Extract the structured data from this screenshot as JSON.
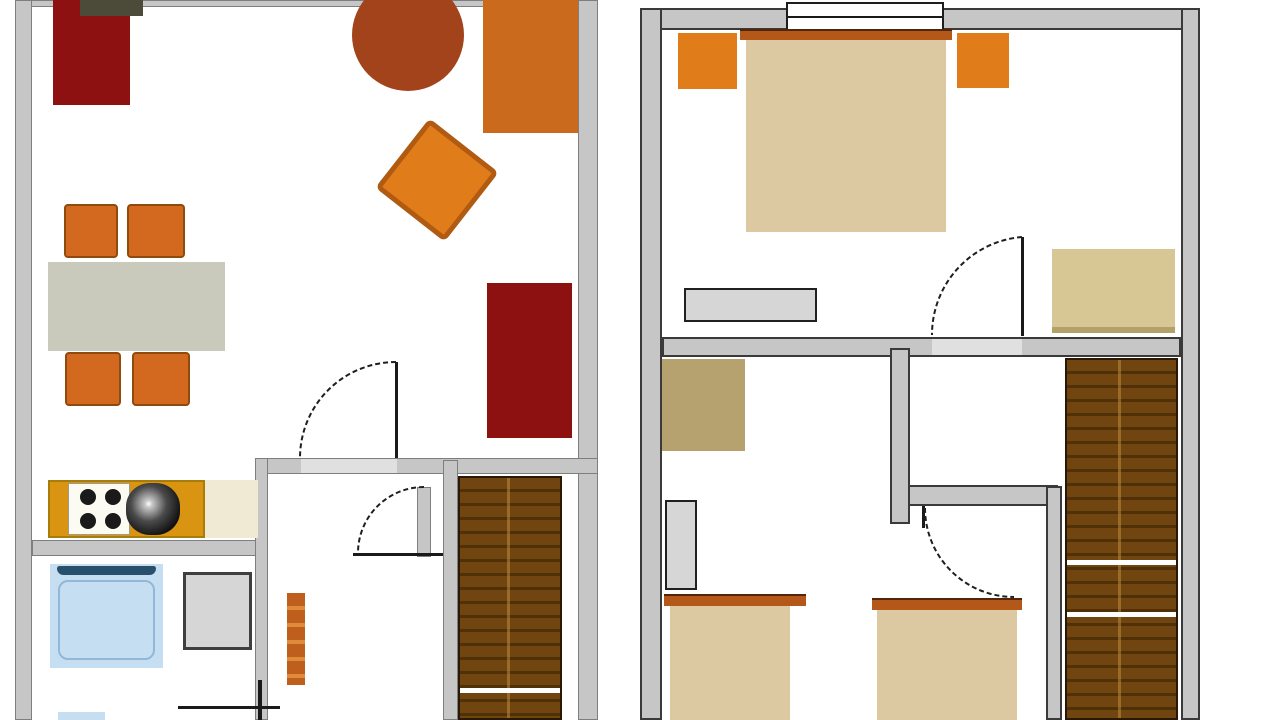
{
  "title": "Two-storey apartment floor plan",
  "floors": [
    {
      "id": "ground-floor",
      "position": "left",
      "rooms": [
        "living-room",
        "dining-area",
        "kitchen",
        "bathroom",
        "hallway",
        "staircase"
      ]
    },
    {
      "id": "upper-floor",
      "position": "right",
      "rooms": [
        "bedroom-main",
        "bedroom-second",
        "landing",
        "staircase"
      ]
    }
  ],
  "palette": {
    "wall": "#c6c6c6",
    "threshold": "#e0e0e0",
    "darkRed": "#8e1111",
    "tvOlive": "#4c4a38",
    "sienna": "#a2431b",
    "orange": "#d2691e",
    "brightOrange": "#e07c1a",
    "sofaOrange": "#c96a1c",
    "tableGray": "#c9c9bc",
    "counterGold": "#d99411",
    "counterCream": "#f0ead4",
    "stoveWhite": "#fbfbf2",
    "black": "#1a1a1a",
    "tubBlue": "#c6def2",
    "tubEdge": "#29506b",
    "applianceGray": "#d6d6d6",
    "radiatorOrange": "#bf5f1d",
    "radiatorLight": "#e08a3c",
    "stairWood": "#714510",
    "stairStep": "#4f3007",
    "bedTan": "#dcc8a1",
    "headboardSienna": "#b4581a",
    "deskKhaki": "#b5a26e",
    "dresserTan": "#d7c794",
    "dresserTanEdge": "#b2a169",
    "white": "#ffffff",
    "doorStroke": "#1f1f1f"
  },
  "shapes": [
    {
      "n": "gf-top-wall",
      "k": "wall",
      "c": "wall",
      "x": 15,
      "y": 0,
      "w": 583,
      "h": 7
    },
    {
      "n": "gf-left-wall",
      "k": "wall",
      "c": "wall",
      "x": 15,
      "y": 0,
      "w": 17,
      "h": 720
    },
    {
      "n": "gf-right-wall",
      "k": "wall",
      "c": "wall",
      "x": 578,
      "y": 0,
      "w": 20,
      "h": 720
    },
    {
      "n": "gf-hall-wall",
      "k": "wall",
      "c": "wall",
      "x": 255,
      "y": 458,
      "w": 343,
      "h": 16
    },
    {
      "n": "gf-living-doorway",
      "k": "threshold",
      "c": "threshold",
      "x": 301,
      "y": 459,
      "w": 96,
      "h": 14
    },
    {
      "n": "gf-kitchen-bath-wall",
      "k": "wall",
      "c": "wall",
      "x": 32,
      "y": 540,
      "w": 236,
      "h": 16
    },
    {
      "n": "gf-bath-hall-wall",
      "k": "wall",
      "c": "wall",
      "x": 255,
      "y": 458,
      "w": 13,
      "h": 262
    },
    {
      "n": "gf-stair-wall",
      "k": "wall",
      "c": "wall",
      "x": 443,
      "y": 460,
      "w": 15,
      "h": 260
    },
    {
      "n": "gf-stair-door-jamb",
      "k": "wall",
      "c": "wall",
      "x": 417,
      "y": 487,
      "w": 14,
      "h": 70
    },
    {
      "n": "tv-stand",
      "k": "rect",
      "c": "darkRed",
      "x": 53,
      "y": 0,
      "w": 77,
      "h": 105
    },
    {
      "n": "tv-set",
      "k": "rect",
      "c": "tvOlive",
      "x": 80,
      "y": 0,
      "w": 63,
      "h": 16
    },
    {
      "n": "coffee-table",
      "k": "circle",
      "c": "sienna",
      "x": 352,
      "y": -21,
      "w": 112,
      "h": 112
    },
    {
      "n": "sofa",
      "k": "sofa",
      "c": "sofaOrange",
      "x": 483,
      "y": 0,
      "w": 95,
      "h": 133
    },
    {
      "n": "armchair-rotated",
      "k": "armchair",
      "c": "brightOrange",
      "x": 393,
      "y": 136,
      "w": 88,
      "h": 88,
      "r": 38
    },
    {
      "n": "dining-chair-1",
      "k": "chair",
      "c": "orange",
      "x": 64,
      "y": 204,
      "w": 54,
      "h": 54
    },
    {
      "n": "dining-chair-2",
      "k": "chair",
      "c": "orange",
      "x": 127,
      "y": 204,
      "w": 58,
      "h": 54
    },
    {
      "n": "dining-table",
      "k": "rect",
      "c": "tableGray",
      "x": 48,
      "y": 262,
      "w": 177,
      "h": 89
    },
    {
      "n": "dining-chair-3",
      "k": "chair",
      "c": "orange",
      "x": 65,
      "y": 352,
      "w": 56,
      "h": 54
    },
    {
      "n": "dining-chair-4",
      "k": "chair",
      "c": "orange",
      "x": 132,
      "y": 352,
      "w": 58,
      "h": 54
    },
    {
      "n": "reading-chair",
      "k": "rect",
      "c": "darkRed",
      "x": 487,
      "y": 283,
      "w": 85,
      "h": 155
    },
    {
      "n": "kitchen-counter",
      "k": "counter",
      "c": "counterGold",
      "x": 48,
      "y": 480,
      "w": 157,
      "h": 58
    },
    {
      "n": "stove",
      "k": "stove",
      "c": "stoveWhite",
      "x": 68,
      "y": 483,
      "w": 62,
      "h": 52
    },
    {
      "n": "burner-1",
      "k": "burner",
      "c": "black",
      "x": 80,
      "y": 489,
      "w": 16,
      "h": 16
    },
    {
      "n": "burner-2",
      "k": "burner",
      "c": "black",
      "x": 105,
      "y": 489,
      "w": 16,
      "h": 16
    },
    {
      "n": "burner-3",
      "k": "burner",
      "c": "black",
      "x": 80,
      "y": 513,
      "w": 16,
      "h": 16
    },
    {
      "n": "burner-4",
      "k": "burner",
      "c": "black",
      "x": 105,
      "y": 513,
      "w": 16,
      "h": 16
    },
    {
      "n": "kitchen-sink",
      "k": "sink",
      "c": "black",
      "x": 126,
      "y": 483,
      "w": 54,
      "h": 52
    },
    {
      "n": "counter-worktop",
      "k": "rect",
      "c": "counterCream",
      "x": 205,
      "y": 480,
      "w": 53,
      "h": 58
    },
    {
      "n": "bathtub",
      "k": "tub",
      "c": "tubBlue",
      "x": 50,
      "y": 564,
      "w": 113,
      "h": 104
    },
    {
      "n": "bathtub-rim",
      "k": "tubbar",
      "c": "tubEdge",
      "x": 57,
      "y": 566,
      "w": 99,
      "h": 9
    },
    {
      "n": "bathtub-inner",
      "k": "tubinner",
      "x": 58,
      "y": 580,
      "w": 97,
      "h": 80
    },
    {
      "n": "washing-machine",
      "k": "appliance",
      "c": "applianceGray",
      "x": 183,
      "y": 572,
      "w": 69,
      "h": 78
    },
    {
      "n": "bathroom-sink",
      "k": "rect",
      "c": "tubBlue",
      "x": 58,
      "y": 712,
      "w": 47,
      "h": 8
    },
    {
      "n": "hall-radiator",
      "k": "radiator",
      "c": "radiatorOrange",
      "c2": "radiatorLight",
      "x": 287,
      "y": 593,
      "w": 18,
      "h": 92
    },
    {
      "n": "bath-door-frame-h",
      "k": "line",
      "c": "black",
      "x": 178,
      "y": 706,
      "w": 102,
      "h": 3
    },
    {
      "n": "bath-door-frame-v",
      "k": "line",
      "c": "black",
      "x": 258,
      "y": 680,
      "w": 4,
      "h": 40
    },
    {
      "n": "gf-staircase",
      "k": "stairs",
      "c": "stairWood",
      "c2": "stairStep",
      "x": 458,
      "y": 476,
      "w": 104,
      "h": 244
    },
    {
      "n": "gf-stair-landing-line",
      "k": "divider",
      "c": "white",
      "x": 460,
      "y": 688,
      "w": 100,
      "h": 5
    },
    {
      "n": "living-door-leaf",
      "k": "doorleaf",
      "c": "black",
      "x": 395,
      "y": 362,
      "w": 3,
      "h": 96
    },
    {
      "n": "stair-door-leaf",
      "k": "doorleaf",
      "c": "black",
      "x": 353,
      "y": 553,
      "w": 90,
      "h": 3
    },
    {
      "n": "uf-top-wall",
      "k": "wallb",
      "c": "wall",
      "x": 640,
      "y": 8,
      "w": 560,
      "h": 22
    },
    {
      "n": "uf-left-wall",
      "k": "wallb",
      "c": "wall",
      "x": 640,
      "y": 8,
      "w": 22,
      "h": 712
    },
    {
      "n": "uf-right-wall",
      "k": "wallb",
      "c": "wall",
      "x": 1181,
      "y": 8,
      "w": 19,
      "h": 712
    },
    {
      "n": "uf-bedroom-wall",
      "k": "wallb",
      "c": "wall",
      "x": 662,
      "y": 337,
      "w": 519,
      "h": 20
    },
    {
      "n": "uf-bedroom-doorway",
      "k": "threshold",
      "c": "threshold",
      "x": 932,
      "y": 339,
      "w": 90,
      "h": 16
    },
    {
      "n": "uf-inner-wall-vertical",
      "k": "wallb",
      "c": "wall",
      "x": 890,
      "y": 348,
      "w": 20,
      "h": 176
    },
    {
      "n": "uf-inner-wall-horizontal",
      "k": "wallb",
      "c": "wall",
      "x": 908,
      "y": 485,
      "w": 150,
      "h": 21
    },
    {
      "n": "uf-stair-wall",
      "k": "wallb",
      "c": "wall",
      "x": 1046,
      "y": 486,
      "w": 16,
      "h": 234
    },
    {
      "n": "bedroom-window",
      "k": "window",
      "x": 786,
      "y": 2,
      "w": 158,
      "h": 38
    },
    {
      "n": "bedroom-window-mullion",
      "k": "line",
      "c": "black",
      "x": 788,
      "y": 16,
      "w": 154,
      "h": 2
    },
    {
      "n": "double-bed-headboard",
      "k": "headboard",
      "c": "headboardSienna",
      "x": 740,
      "y": 29,
      "w": 212,
      "h": 11
    },
    {
      "n": "double-bed",
      "k": "bed",
      "c": "bedTan",
      "x": 746,
      "y": 40,
      "w": 200,
      "h": 192
    },
    {
      "n": "nightstand-left",
      "k": "rect",
      "c": "brightOrange",
      "x": 678,
      "y": 33,
      "w": 59,
      "h": 56
    },
    {
      "n": "nightstand-right",
      "k": "rect",
      "c": "brightOrange",
      "x": 957,
      "y": 33,
      "w": 52,
      "h": 55
    },
    {
      "n": "bedroom-dresser-low",
      "k": "dresser",
      "c": "applianceGray",
      "x": 684,
      "y": 288,
      "w": 133,
      "h": 34
    },
    {
      "n": "bedroom-chest-tan",
      "k": "rect",
      "c": "dresserTan",
      "x": 1052,
      "y": 249,
      "w": 123,
      "h": 84
    },
    {
      "n": "bedroom-chest-tan-edge",
      "k": "line",
      "c": "dresserTanEdge",
      "x": 1052,
      "y": 327,
      "w": 123,
      "h": 6
    },
    {
      "n": "bedroom-door-leaf",
      "k": "doorleaf",
      "c": "black",
      "x": 1021,
      "y": 237,
      "w": 3,
      "h": 99
    },
    {
      "n": "desk",
      "k": "rect",
      "c": "deskKhaki",
      "x": 662,
      "y": 359,
      "w": 83,
      "h": 92
    },
    {
      "n": "wardrobe",
      "k": "dresser",
      "c": "applianceGray",
      "x": 665,
      "y": 500,
      "w": 32,
      "h": 90
    },
    {
      "n": "single-bed-1-headboard",
      "k": "headboard",
      "c": "headboardSienna",
      "x": 664,
      "y": 594,
      "w": 142,
      "h": 12
    },
    {
      "n": "single-bed-1",
      "k": "bed",
      "c": "bedTan",
      "x": 670,
      "y": 606,
      "w": 120,
      "h": 114
    },
    {
      "n": "single-bed-2-headboard",
      "k": "headboard",
      "c": "headboardSienna",
      "x": 872,
      "y": 598,
      "w": 150,
      "h": 12
    },
    {
      "n": "single-bed-2",
      "k": "bed",
      "c": "bedTan",
      "x": 877,
      "y": 610,
      "w": 140,
      "h": 110
    },
    {
      "n": "uf-staircase",
      "k": "stairs",
      "c": "stairWood",
      "c2": "stairStep",
      "x": 1065,
      "y": 358,
      "w": 113,
      "h": 362
    },
    {
      "n": "uf-stair-landing-line-1",
      "k": "divider",
      "c": "white",
      "x": 1067,
      "y": 560,
      "w": 109,
      "h": 5
    },
    {
      "n": "uf-stair-landing-line-2",
      "k": "divider",
      "c": "white",
      "x": 1067,
      "y": 612,
      "w": 109,
      "h": 5
    },
    {
      "n": "second-bedroom-door-leaf",
      "k": "doorleaf",
      "c": "black",
      "x": 922,
      "y": 506,
      "w": 3,
      "h": 22
    }
  ],
  "door_arcs": [
    {
      "n": "living-door-arc",
      "d": "M 396 362 A 96 96 0 0 0 300 458"
    },
    {
      "n": "stair-door-arc",
      "d": "M 424 487 A 66 66 0 0 0 358 553"
    },
    {
      "n": "bedroom-door-arc",
      "d": "M 1022 237 A 98 98 0 0 0 932 335"
    },
    {
      "n": "second-bedroom-door-arc",
      "d": "M 925 508 A 89 89 0 0 0 1014 597"
    }
  ]
}
